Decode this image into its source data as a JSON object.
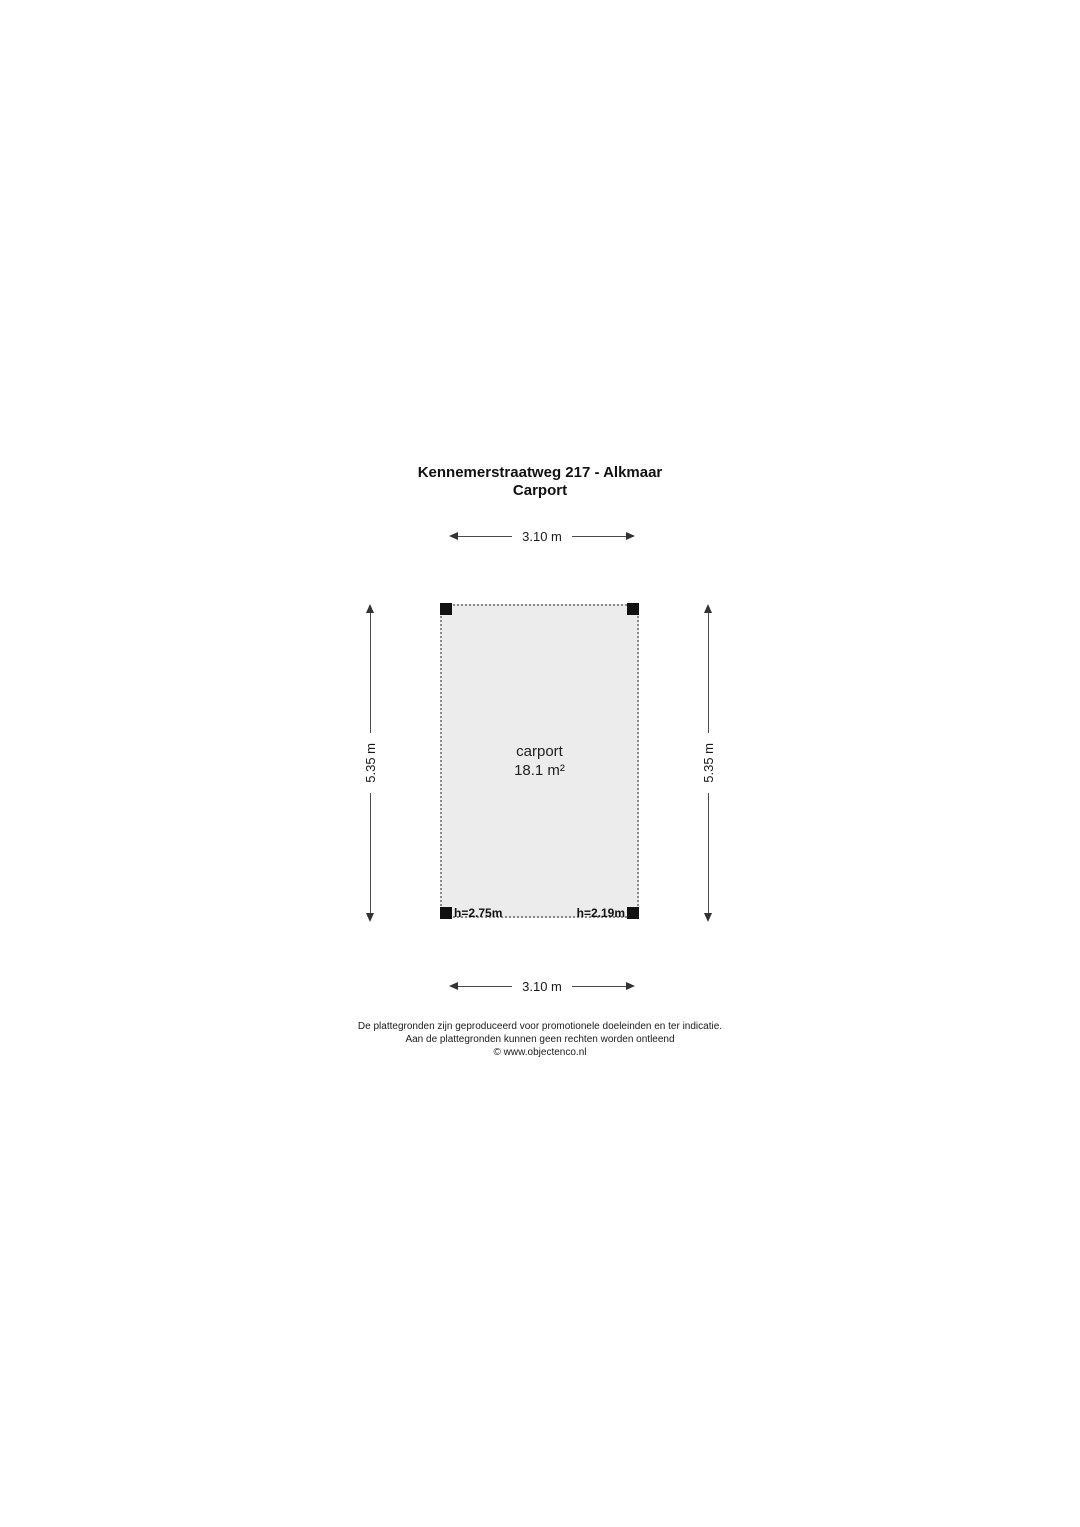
{
  "title": {
    "line1": "Kennemerstraatweg 217 - Alkmaar",
    "line2": "Carport"
  },
  "dimensions": {
    "top": "3.10 m",
    "bottom": "3.10 m",
    "left": "5.35 m",
    "right": "5.35 m"
  },
  "room": {
    "name": "carport",
    "area": "18.1 m²",
    "height_left": "h=2.75m",
    "height_right": "h=2.19m"
  },
  "footer": {
    "line1": "De plattegronden zijn geproduceerd voor promotionele doeleinden en ter indicatie.",
    "line2": "Aan de plattegronden kunnen geen rechten worden ontleend",
    "line3": "© www.objectenco.nl"
  },
  "colors": {
    "room_fill": "#ececec",
    "room_border": "#8a8a8a",
    "dimension_line": "#4a4a4a",
    "post": "#111111",
    "text": "#1a1a1a"
  }
}
